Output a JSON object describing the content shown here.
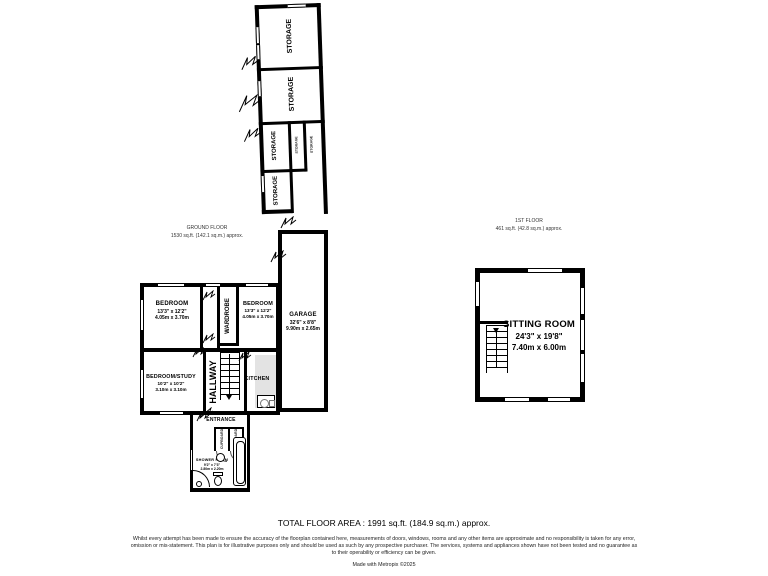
{
  "plan": {
    "ground_floor": {
      "title": "GROUND FLOOR",
      "area": "1530 sq.ft. (142.1 sq.m.) approx."
    },
    "first_floor": {
      "title": "1ST FLOOR",
      "area": "461 sq.ft. (42.8 sq.m.) approx."
    }
  },
  "rooms": {
    "storage_top": {
      "name": "STORAGE"
    },
    "storage_upper": {
      "name": "STORAGE"
    },
    "storage_mid": {
      "name": "STORAGE"
    },
    "storage_closet_a": {
      "name": "STORAGE"
    },
    "storage_closet_b": {
      "name": "STORAGE"
    },
    "storage_lower": {
      "name": "STORAGE"
    },
    "garage": {
      "name": "GARAGE",
      "imperial": "32'6\" x 8'8\"",
      "metric": "9.90m x 2.65m"
    },
    "bedroom_left": {
      "name": "BEDROOM",
      "imperial": "13'3\" x 12'2\"",
      "metric": "4.05m x 3.70m"
    },
    "bedroom_right": {
      "name": "BEDROOM",
      "imperial": "13'3\" x 12'2\"",
      "metric": "4.05m x 3.70m"
    },
    "wardrobe": {
      "name": "WARDROBE"
    },
    "bedroom_study": {
      "name": "BEDROOM/STUDY",
      "imperial": "10'2\" x 10'2\"",
      "metric": "3.10m x 3.10m"
    },
    "hallway": {
      "name": "HALLWAY"
    },
    "kitchen": {
      "name": "KITCHEN"
    },
    "entrance": {
      "name": "ENTRANCE"
    },
    "cupboard_a": {
      "name": "CUPBOARD"
    },
    "cupboard_b": {
      "name": "CUPBOARD"
    },
    "shower_room": {
      "name": "SHOWER ROOM",
      "imperial": "9'2\" x 7'3\"",
      "metric": "2.80m x 2.20m"
    },
    "sitting_room": {
      "name": "SITTING ROOM",
      "imperial": "24'3\" x 19'8\"",
      "metric": "7.40m x 6.00m"
    }
  },
  "footer": {
    "total_area": "TOTAL FLOOR AREA : 1991 sq.ft. (184.9 sq.m.) approx.",
    "disclaimer": "Whilst every attempt has been made to ensure the accuracy of the floorplan contained here, measurements of doors, windows, rooms and any other items are approximate and no responsibility is taken for any error, omission or mis-statement. This plan is for illustrative purposes only and should be used as such by any prospective purchaser. The services, systems and appliances shown have not been tested and no guarantee as to their operability or efficiency can be given.",
    "credit": "Made with Metropix ©2025"
  },
  "colors": {
    "wall": "#000000",
    "counter": "#e3e3e3",
    "background": "#ffffff"
  }
}
